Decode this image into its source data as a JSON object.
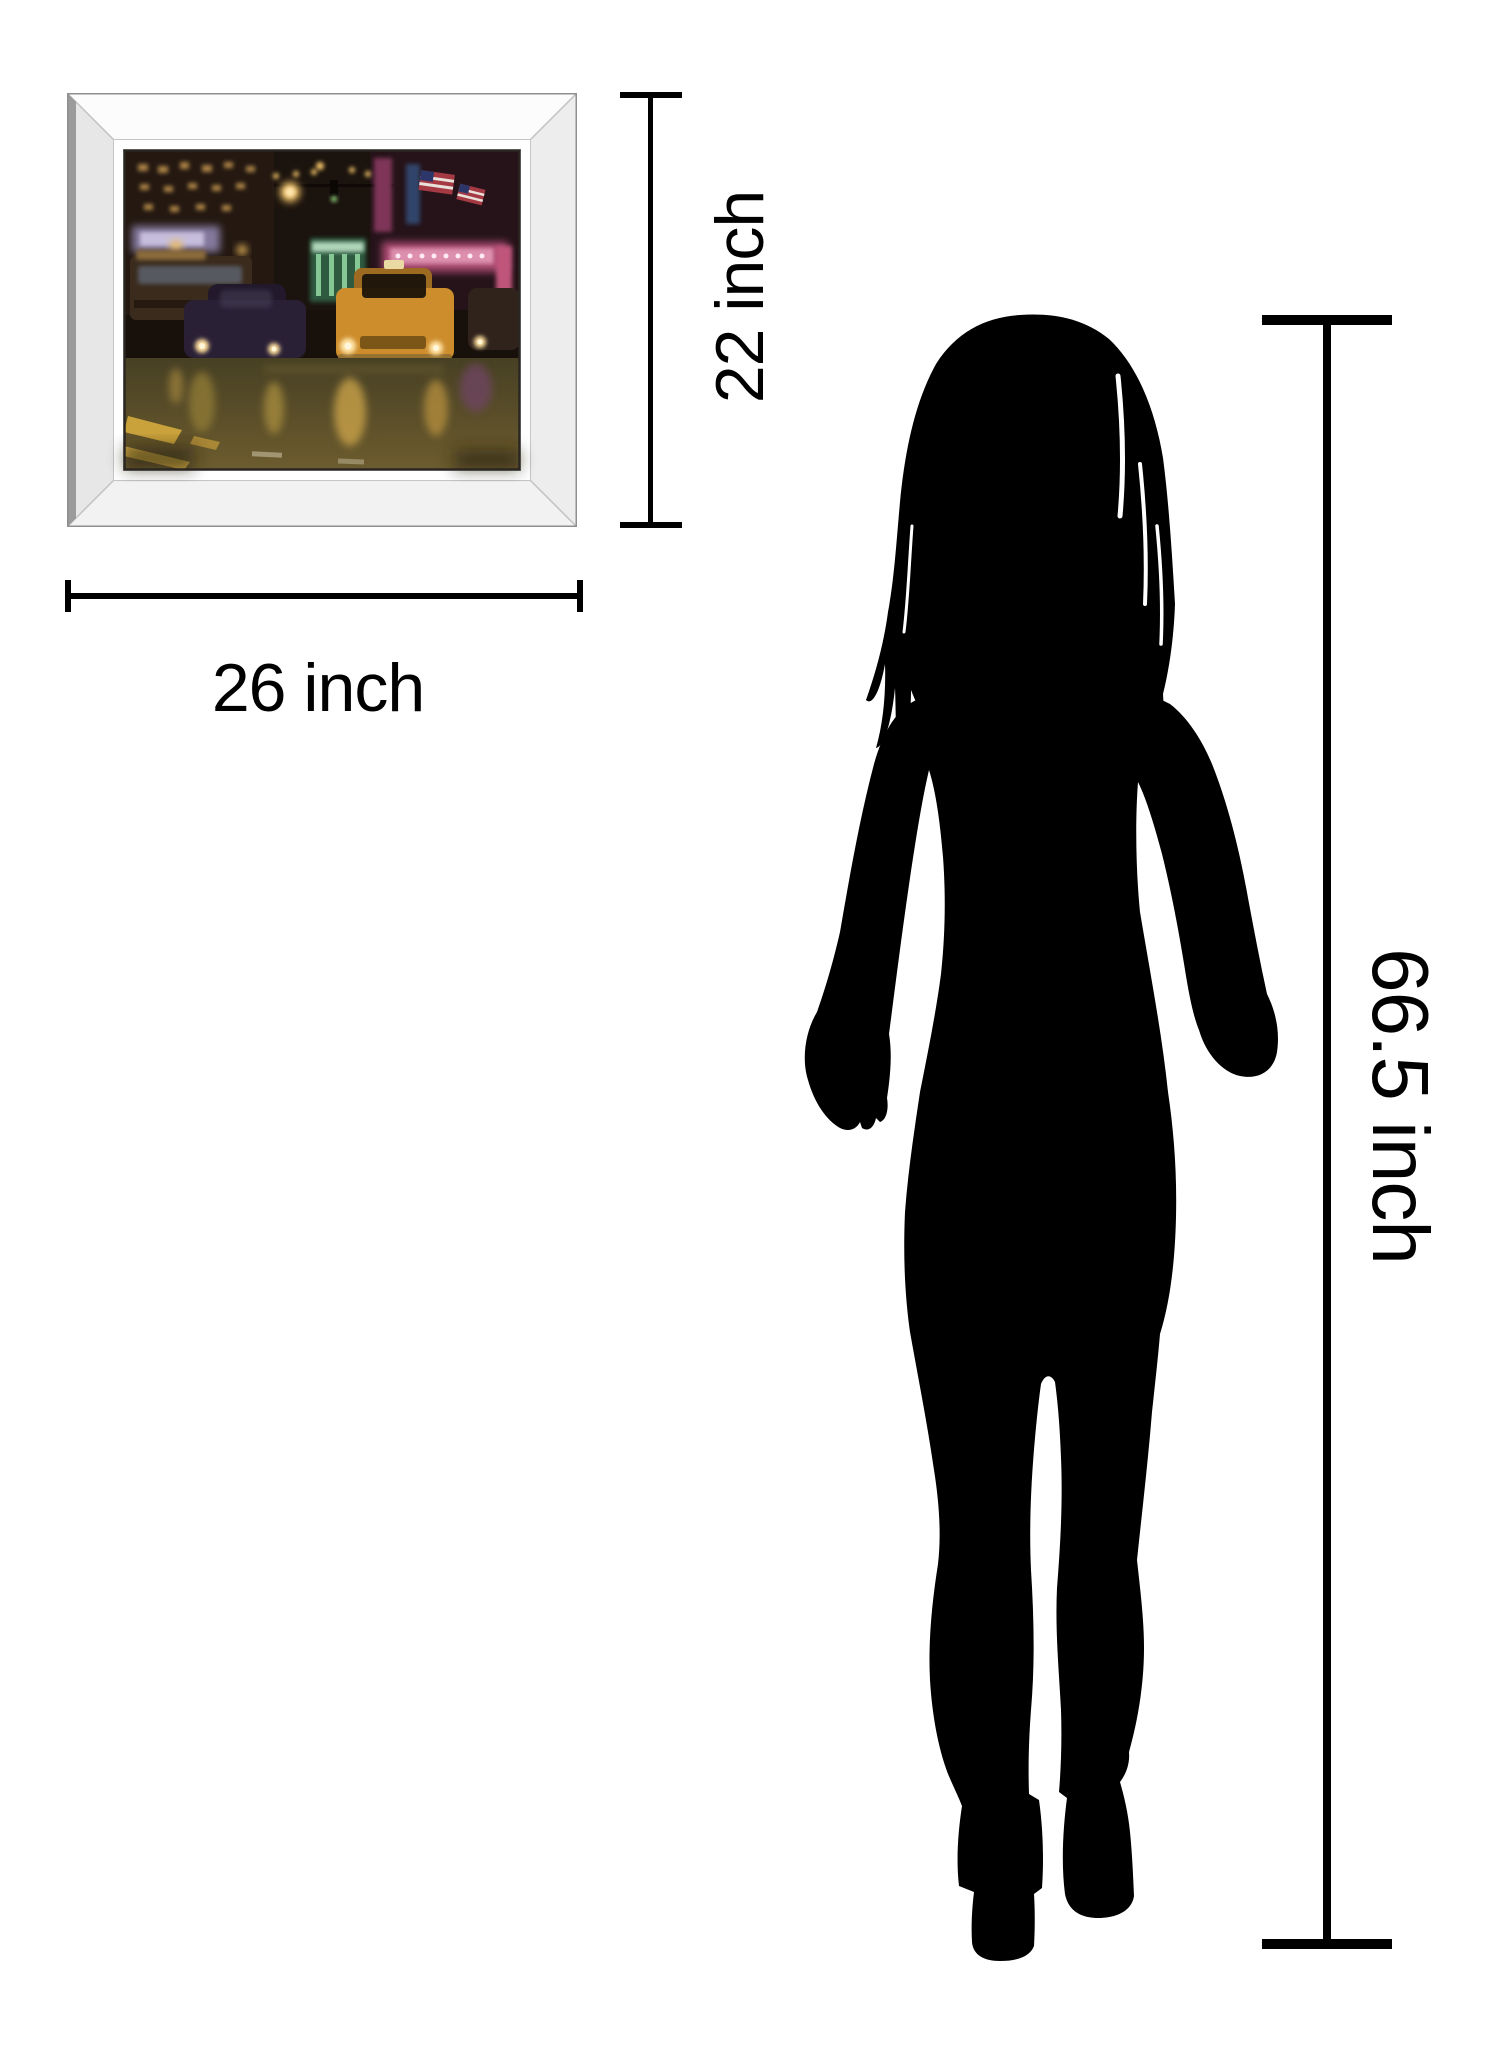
{
  "artwork": {
    "width_dimension": {
      "label": "26 inch",
      "value": 26,
      "unit": "inch"
    },
    "height_dimension": {
      "label": "22 inch",
      "value": 22,
      "unit": "inch"
    }
  },
  "person": {
    "height_dimension": {
      "label": "66.5 inch",
      "value": 66.5,
      "unit": "inch"
    }
  },
  "colors": {
    "dimension_lines": "#000000",
    "silhouette": "#000000",
    "frame": "#f2f2f2",
    "taxi_accent": "#cd8d2d",
    "background": "#ffffff"
  }
}
